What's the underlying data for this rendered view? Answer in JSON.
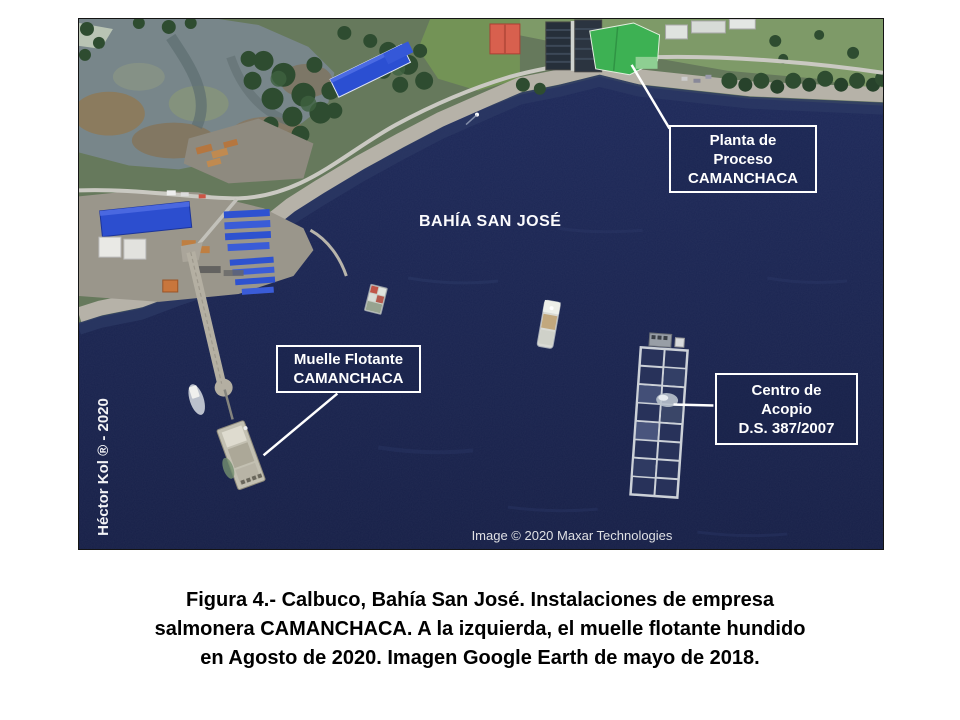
{
  "figure": {
    "bay_label": "BAHÍA SAN JOSÉ",
    "labels": {
      "planta": "Planta de\nProceso\nCAMANCHACA",
      "muelle": "Muelle Flotante\nCAMANCHACA",
      "centro": "Centro de\nAcopio\nD.S. 387/2007"
    },
    "author_credit": "Héctor Kol ® - 2020",
    "attribution": "Image © 2020 Maxar Technologies"
  },
  "caption": {
    "text": "Figura 4.- Calbuco, Bahía San José. Instalaciones de empresa\nsalmonera CAMANCHACA. A la izquierda, el muelle flotante hundido\nen Agosto de 2020. Imagen Google Earth de mayo de 2018."
  },
  "colors": {
    "ocean": "#1b2550",
    "label_border": "#ffffff",
    "label_text": "#ffffff",
    "caption_text": "#000000"
  }
}
